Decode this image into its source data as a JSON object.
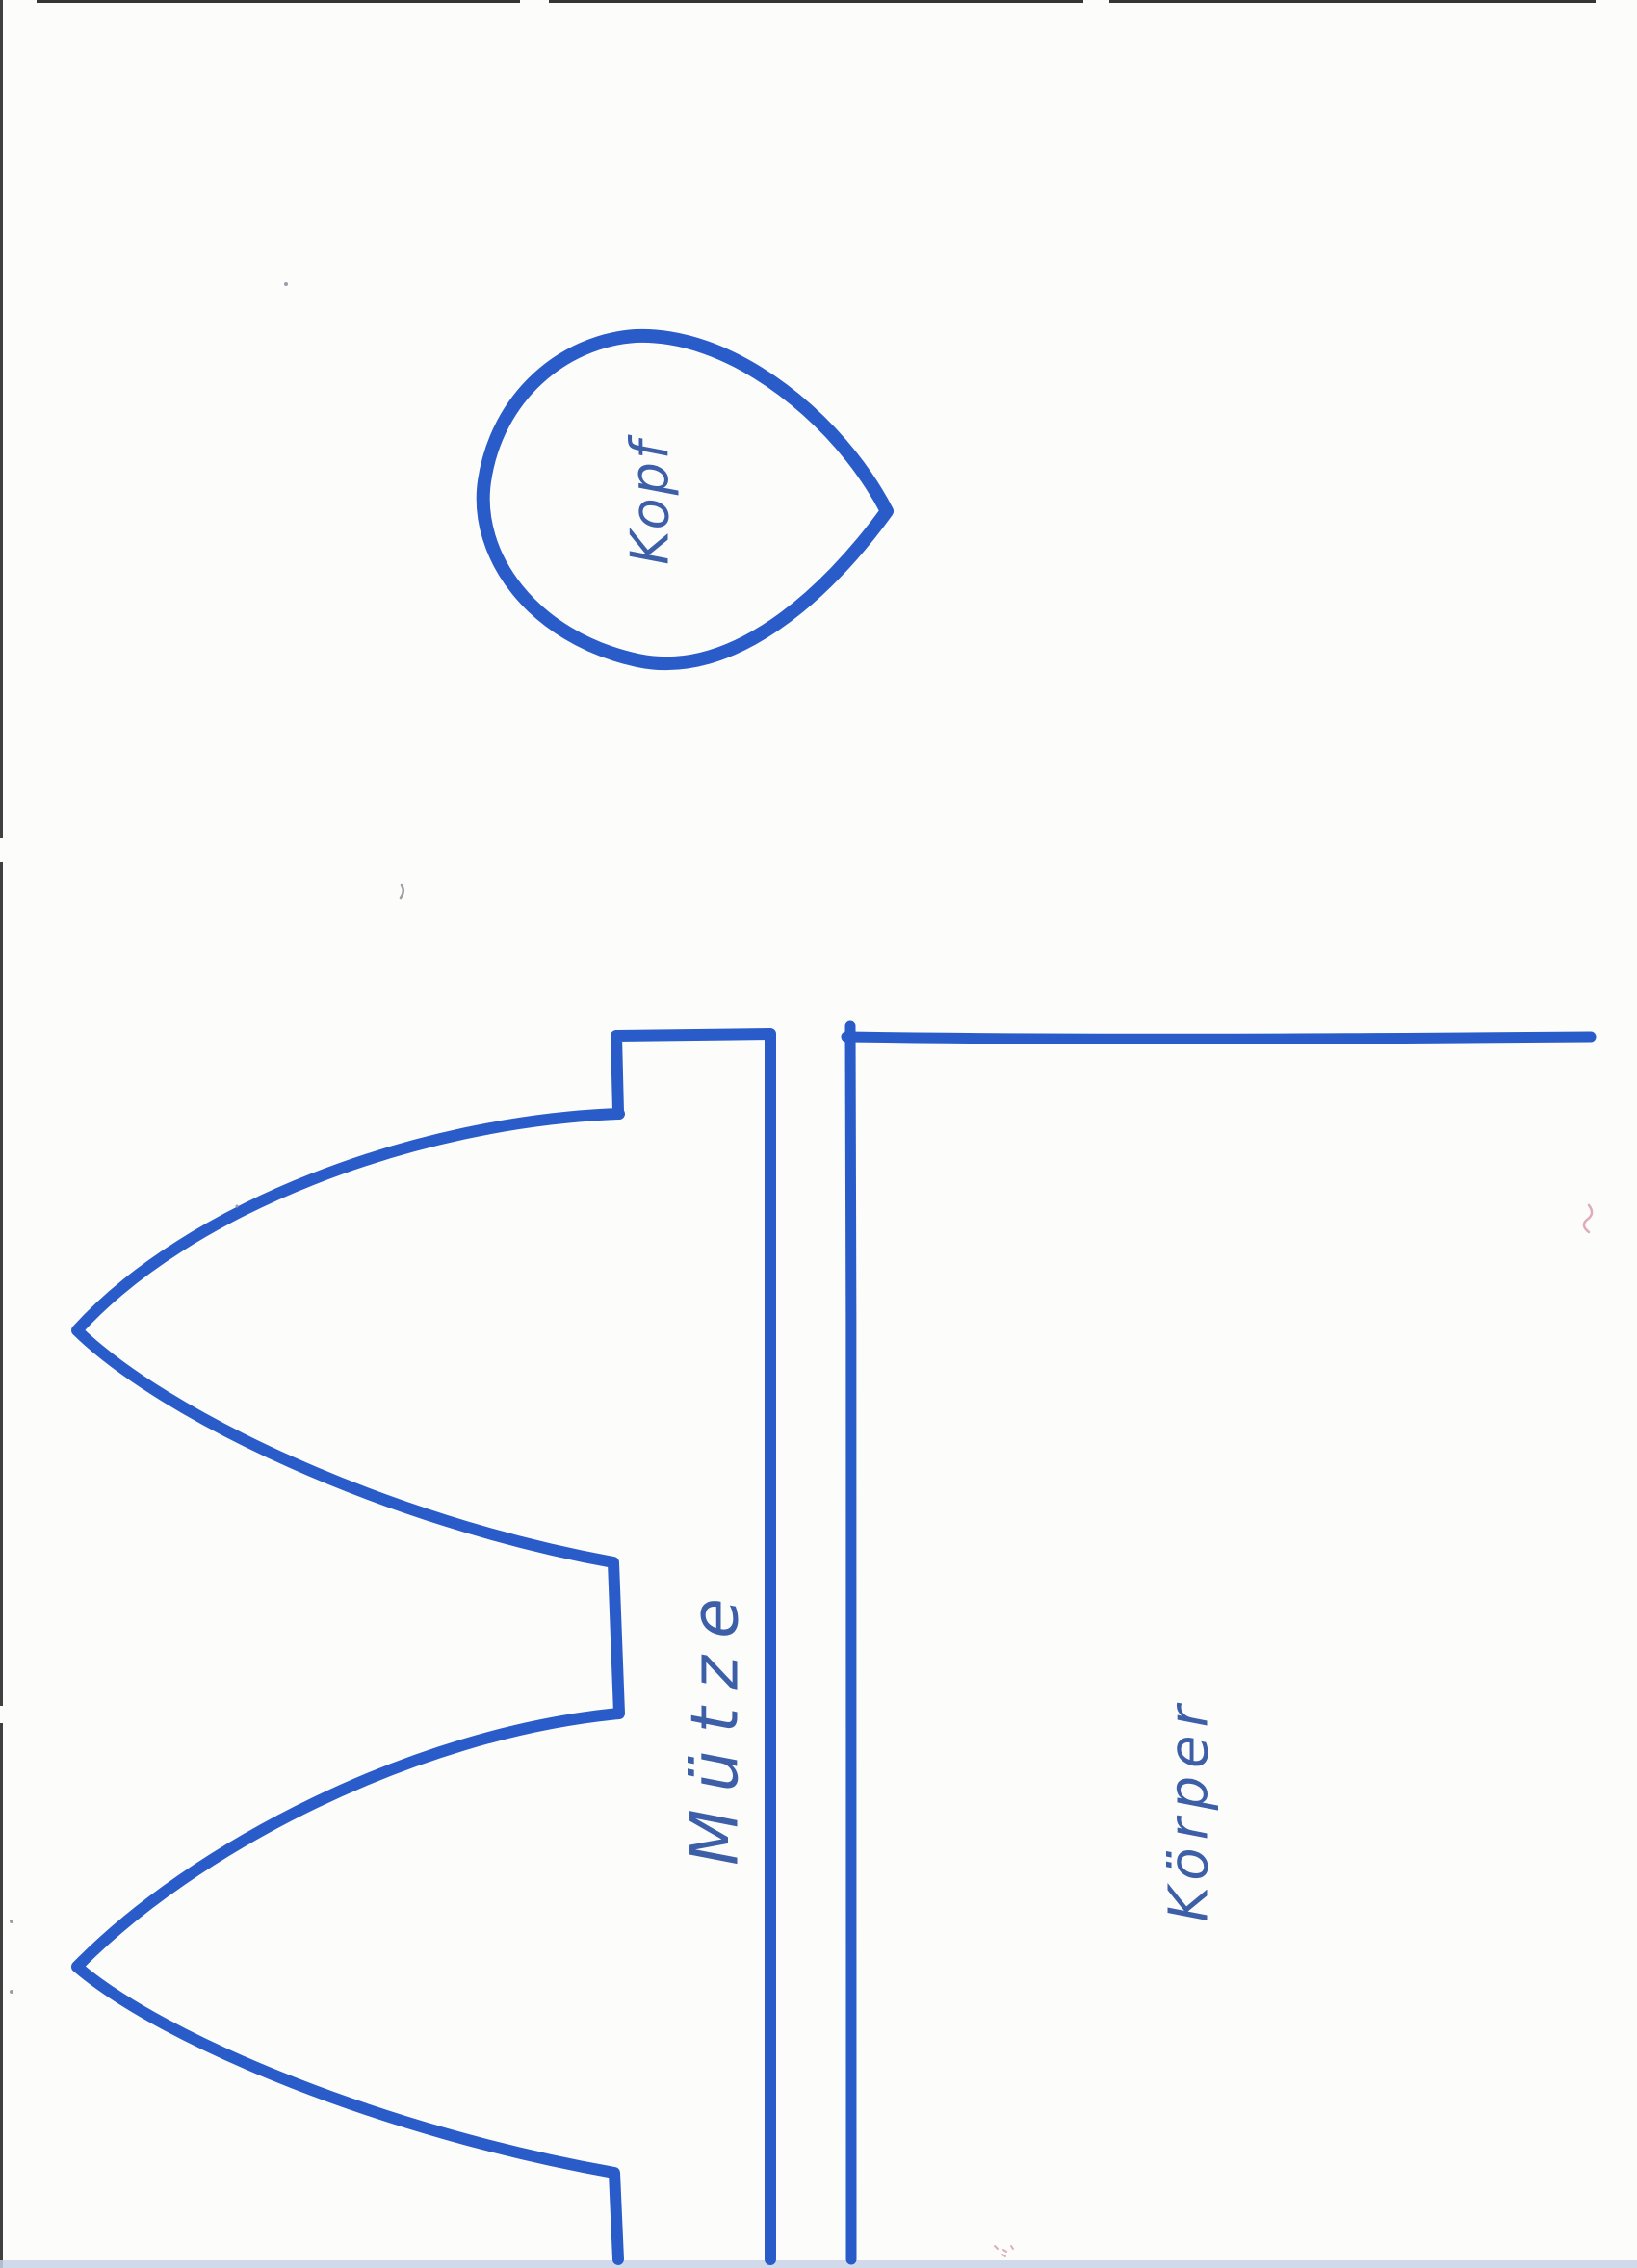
{
  "pieces": [
    {
      "id": "head",
      "label": "Kopf"
    },
    {
      "id": "hat",
      "label": "Mütze"
    },
    {
      "id": "body",
      "label": "Körper"
    }
  ],
  "colors": {
    "marker_blue": "#2a5cc9",
    "pen_blue": "#3c5fa8",
    "paper_white": "#fcfcfb",
    "scan_edge_dark": "#1f1f1f",
    "scan_edge_bottom_band": "#c9d3e7",
    "speck_gray": "#9a9ea8",
    "speck_pink": "#d897ab"
  }
}
